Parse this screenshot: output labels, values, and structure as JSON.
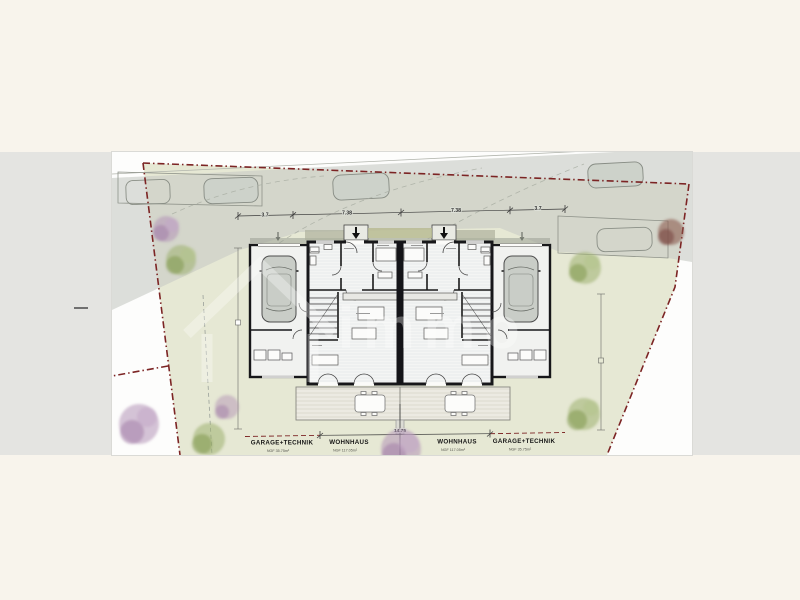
{
  "page": {
    "background_color": "#f8f4ec",
    "strip_color": "#e4e4e1"
  },
  "site_plan": {
    "type": "architectural-site-plan",
    "colors": {
      "lawn": "#e6e8d4",
      "road": "#d5d8d1",
      "boundary_red": "#7c2424",
      "wall_black": "#17171a",
      "terrace": "#eceae2",
      "tree_purple": "#b394b6",
      "tree_green": "#9cb06e",
      "tree_darkred": "#8c5a50"
    },
    "dimensions_top": [
      "3.7",
      "7.38",
      "7.38",
      "3.7"
    ],
    "total_width_bottom": "14.75",
    "units": [
      {
        "label": "GARAGE+TECHNIK",
        "area": "NGF 35.75m²"
      },
      {
        "label": "WOHNHAUS",
        "area": "NGF 117.05m²"
      },
      {
        "label": "WOHNHAUS",
        "area": "NGF 117.05m²"
      },
      {
        "label": "GARAGE+TECHNIK",
        "area": "NGF 35.75m²"
      }
    ],
    "watermark": "immo"
  }
}
